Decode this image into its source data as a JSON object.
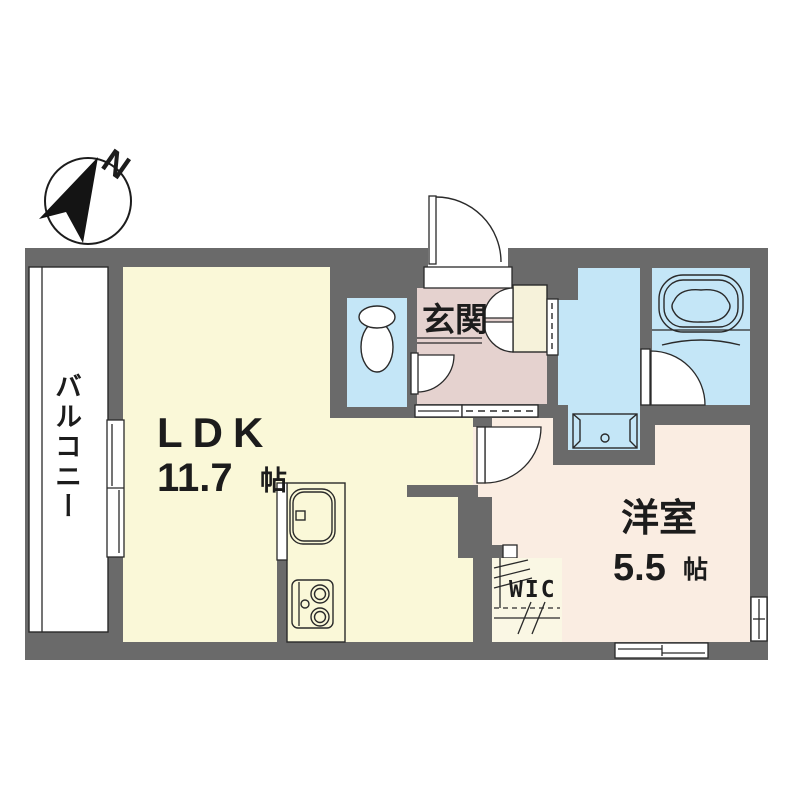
{
  "compass": {
    "north_label": "N"
  },
  "rooms": {
    "balcony": {
      "label": "バルコニー"
    },
    "ldk": {
      "label": "LDK",
      "area_value": "11.7",
      "area_unit": "帖"
    },
    "entrance": {
      "label": "玄関"
    },
    "western_room": {
      "label": "洋室",
      "area_value": "5.5",
      "area_unit": "帖"
    },
    "wic": {
      "label": "WIC"
    }
  },
  "colors": {
    "wall": "#6a6a6a",
    "ldk_fill": "#FAF8D8",
    "entrance_fill": "#E5D2CF",
    "western_room_fill": "#FAEDE2",
    "water_area_fill": "#C4E6F7",
    "storage_fill": "#F6F2DA",
    "wic_fill": "#FAF7E4",
    "balcony_fill": "#FFFFFF",
    "line": "#1f1f1f"
  }
}
